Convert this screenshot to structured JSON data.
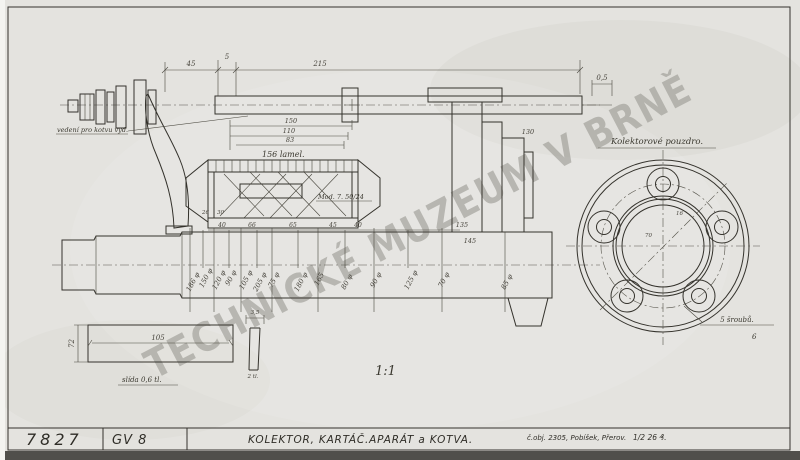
{
  "watermark": "TECHNICKÉ MUZEUM V BRNĚ",
  "scale_label": "1:1",
  "title_block": {
    "drawing_number": "7827",
    "type_code": "GV 8",
    "title": "KOLEKTOR, KARTÁČ.APARÁT a KOTVA.",
    "order_note": "č.obj. 2305, Pobíšek, Přerov.",
    "date_note": "1/2 26 ₰."
  },
  "notes": {
    "left_note": "vedení pro kotvu vyd.",
    "lamels": "156 lamel.",
    "mod": "Mod. 7. 50/24",
    "housing": "Kolektorové pouzdro.",
    "screws": "5 šroubů.",
    "screws_pos": "6",
    "mica": "slída 0,6 tl."
  },
  "dims": {
    "top": [
      "45",
      "5",
      "215",
      "0,5"
    ],
    "collector_stack": [
      "150",
      "110",
      "83"
    ],
    "under_collector": [
      "40",
      "66",
      "65",
      "45",
      "40"
    ],
    "collector_small": [
      "26",
      "30"
    ],
    "housing": [
      "130",
      "135",
      "145"
    ],
    "shaft_diameters": [
      "186 φ",
      "150 φ",
      "120 φ",
      "90 φ",
      "105 φ",
      "205 φ",
      "75 φ",
      "180 φ",
      "165",
      "80 φ",
      "90 φ",
      "125 φ",
      "70 φ",
      "85 φ"
    ],
    "flange_small": [
      "70",
      "16"
    ],
    "detail": {
      "length": "105",
      "height": "72",
      "mica_w": "3,5",
      "mica_t": "2 tl."
    }
  },
  "colors": {
    "paper": "#e4e3df",
    "ink": "#34322c",
    "watermark_gray": "#8e8d86"
  }
}
